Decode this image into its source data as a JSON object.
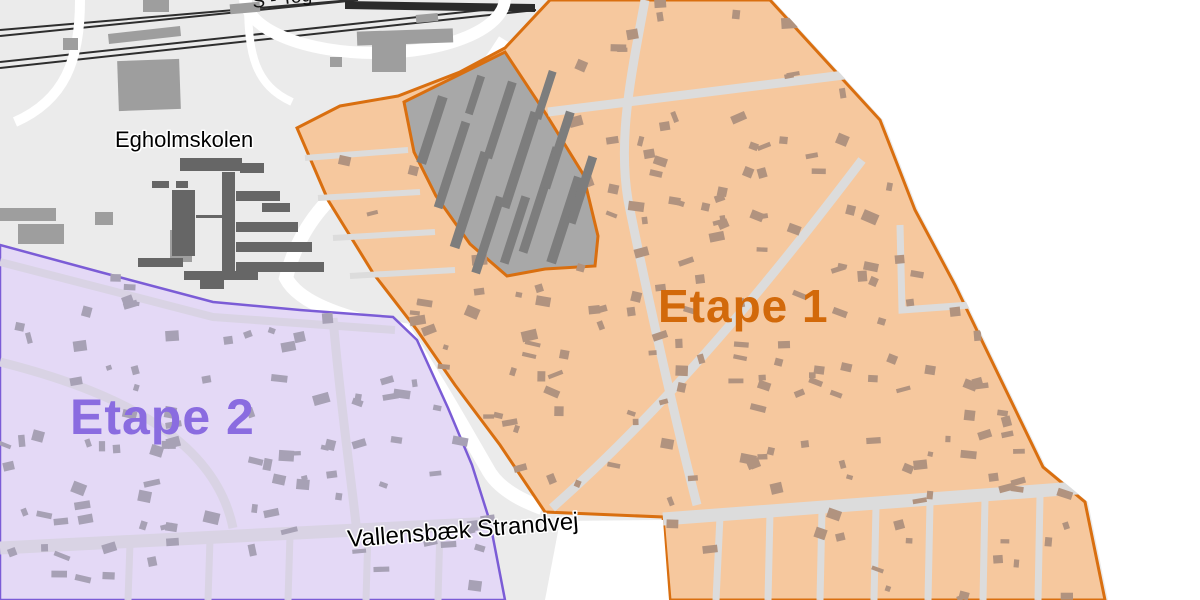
{
  "map": {
    "labels": {
      "railway": "S - Tog",
      "school": "Egholmskolen",
      "stage1": "Etape 1",
      "stage2": "Etape 2",
      "street": "Vallensbæk Strandvej"
    },
    "colors": {
      "background_land": "#ebebeb",
      "outside": "#ffffff",
      "road": "#ffffff",
      "road_stage1": "#dcdcdc",
      "road_stage2": "#d9d3e4",
      "railway": "#2e2e2e",
      "stage1_fill": "#f6c89e",
      "stage1_border": "#d96f10",
      "stage1_label": "#d2690a",
      "stage1_buildings": "#b1937f",
      "stage2_fill": "#e4d9f6",
      "stage2_border": "#7b5cd6",
      "stage2_label": "#8a6ce0",
      "stage2_buildings": "#a7a1b5",
      "excluded_fill": "#a8a8a8",
      "excluded_buildings": "#7d7d7d",
      "general_buildings": "#9e9e9e",
      "school_buildings": "#666666",
      "street_label": "#000000",
      "school_label": "#000000"
    }
  }
}
